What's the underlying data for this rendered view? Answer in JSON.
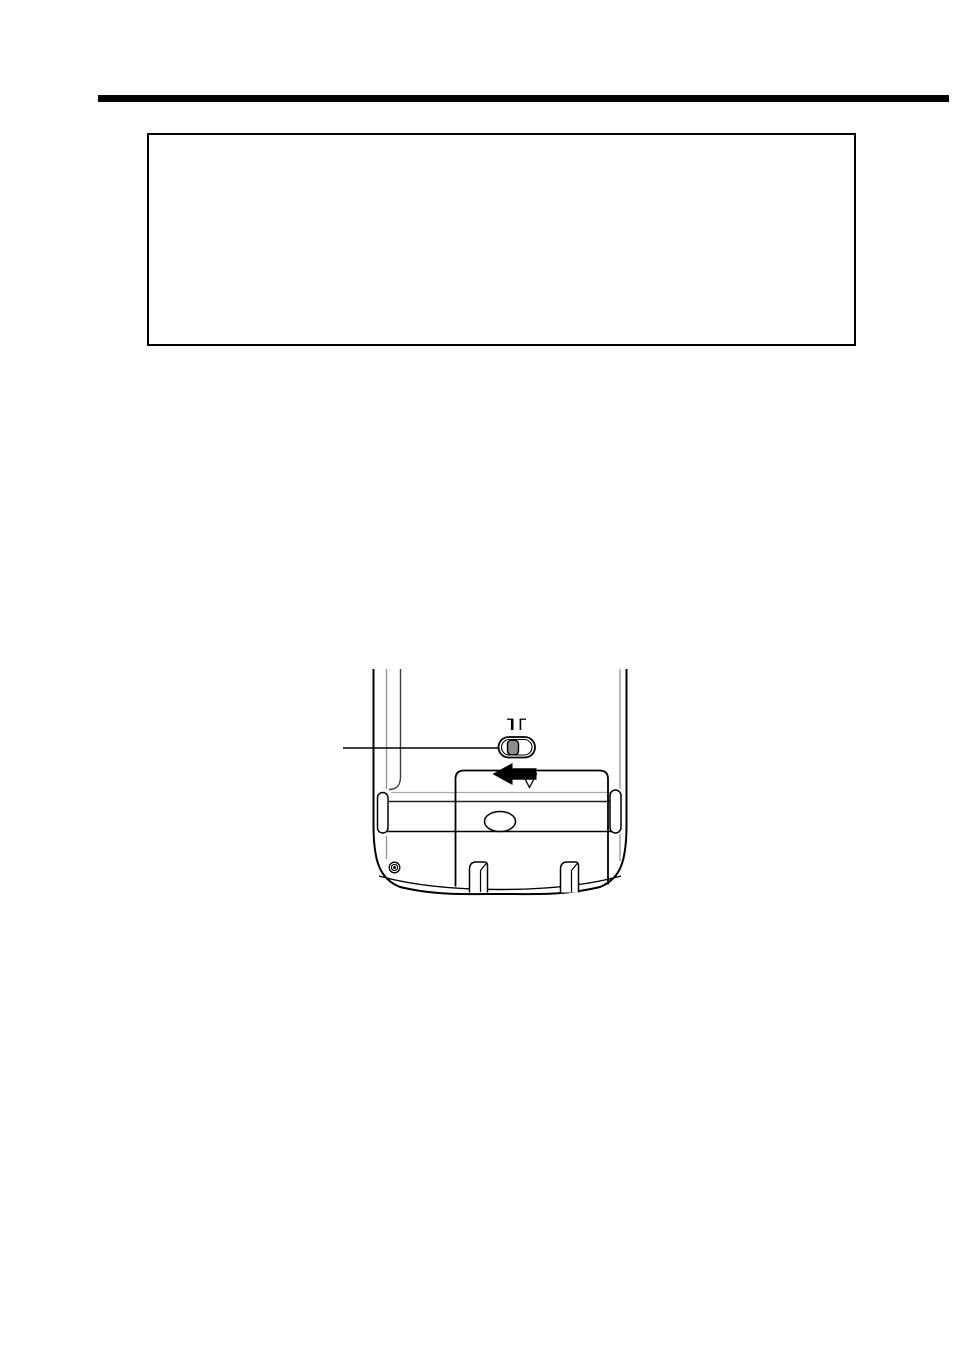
{
  "page": {
    "kind": "scanned manual page",
    "background_color": "#ffffff",
    "visible_text": ""
  },
  "top_rule": {
    "color": "#000000"
  },
  "callout_box": {
    "text": ""
  },
  "figure": {
    "description": "line drawing of the back of a handheld device showing the battery cover being slid open",
    "ink_color": "#000000",
    "secondary_line_color": "#9a9a9a",
    "switch_knob_color": "#8c8c8c",
    "parts": [
      "device-back-outline",
      "inner-panel-line",
      "switch-position-marks",
      "slider-switch",
      "slider-switch-knob",
      "callout-line",
      "slide-direction-arrow",
      "cover-triangle-marker",
      "battery-cover",
      "grip-band-lines",
      "thumb-oval",
      "left-side-notch",
      "right-side-notch",
      "screw",
      "cover-tab-left",
      "cover-tab-right"
    ]
  }
}
